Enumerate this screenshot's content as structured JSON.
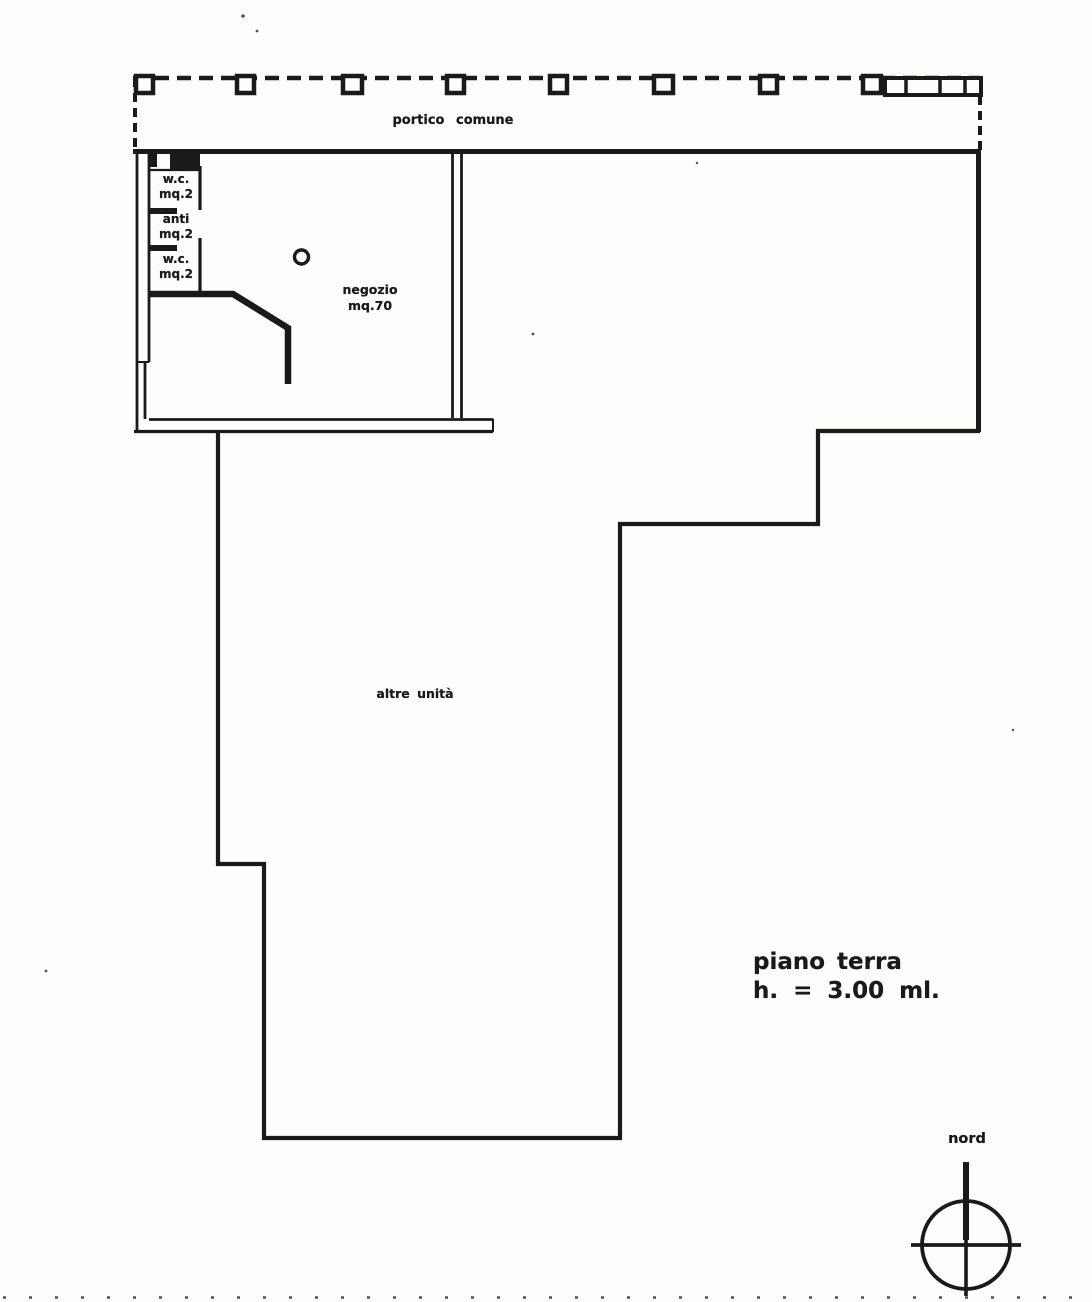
{
  "colors": {
    "ink": "#1a1a1a",
    "paper": "#fdfdfc"
  },
  "portico": {
    "label": "portico comune"
  },
  "rooms": {
    "wc_top": {
      "name": "w.c.",
      "area": "mq.2"
    },
    "anti": {
      "name": "anti",
      "area": "mq.2"
    },
    "wc_bottom": {
      "name": "w.c.",
      "area": "mq.2"
    },
    "negozio": {
      "name": "negozio",
      "area": "mq.70"
    },
    "altre_unita": {
      "name": "altre unità"
    }
  },
  "floor_title": {
    "line1": "piano terra",
    "line2": "h. = 3.00 ml."
  },
  "compass": {
    "label": "nord"
  }
}
